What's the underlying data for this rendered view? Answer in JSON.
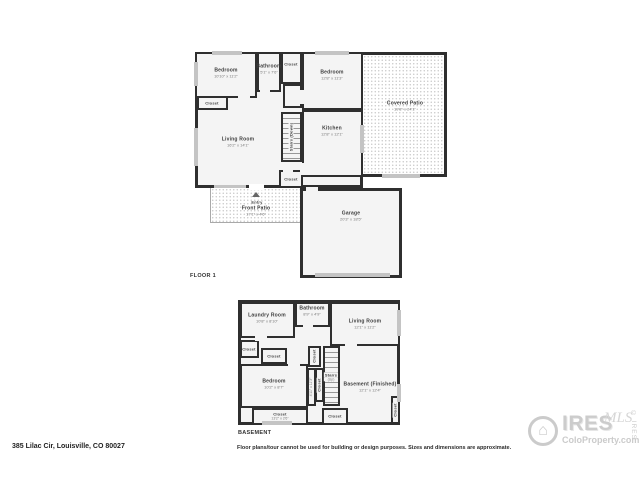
{
  "floor1": {
    "title": "FLOOR 1",
    "rooms": {
      "bedroom1": {
        "name": "Bedroom",
        "dims": "10'10\" x 11'2\""
      },
      "bathroom": {
        "name": "Bathroom",
        "dims": "5'1\" x 7'6\""
      },
      "closet_top": {
        "name": "Closet"
      },
      "bedroom2": {
        "name": "Bedroom",
        "dims": "12'8\" x 11'3\""
      },
      "closet_bed1": {
        "name": "Closet"
      },
      "living_room": {
        "name": "Living Room",
        "dims": "16'2\" x 14'1\""
      },
      "stairs": {
        "name": "Stairs (Down)"
      },
      "kitchen": {
        "name": "Kitchen",
        "dims": "12'8\" x 12'1\""
      },
      "covered_patio": {
        "name": "Covered Patio",
        "dims": "19'8\" x 24'1\""
      },
      "closet_entry": {
        "name": "Closet"
      },
      "entry": {
        "name": "Entry"
      },
      "front_patio": {
        "name": "Front Patio",
        "dims": "17'1\" x 4'6\""
      },
      "garage": {
        "name": "Garage",
        "dims": "20'3\" x 18'5\""
      }
    }
  },
  "basement": {
    "title": "BASEMENT",
    "rooms": {
      "laundry": {
        "name": "Laundry Room",
        "dims": "10'8\" x 8'10\""
      },
      "bathroom": {
        "name": "Bathroom",
        "dims": "8'9\" x 4'9\""
      },
      "living_room": {
        "name": "Living Room",
        "dims": "12'1\" x 11'2\""
      },
      "closet_left": {
        "name": "Closet"
      },
      "closet_left2": {
        "name": "Closet"
      },
      "bedroom": {
        "name": "Bedroom",
        "dims": "10'2\" x 8'7\""
      },
      "closet_stair_top": {
        "name": "Closet"
      },
      "closet_dims": {
        "name": "4'11\" x 11'3\""
      },
      "closet_mid": {
        "name": "Closet"
      },
      "stairs": {
        "name": "Stairs",
        "dims": "(Up)"
      },
      "finished": {
        "name": "Basement (Finished)",
        "dims": "12'1\" x 12'4\""
      },
      "closet_bottom": {
        "name": "Closet",
        "dims": "13'2\" x 2'6\""
      },
      "closet_bottom2": {
        "name": "Closet"
      },
      "closet_right": {
        "name": "Closet"
      }
    }
  },
  "footer": {
    "address": "385 Lilac Cir, Louisville, CO 80027",
    "disclaimer": "Floor plans/tour cannot be used for building or design purposes. Sizes and dimensions are approximate."
  },
  "logo": {
    "house_glyph": "⌂",
    "brand": "IRES",
    "script": "MLS",
    "site": "ColoProperty.com",
    "vertical": "© IRES",
    "color": "#cbcbcb"
  },
  "colors": {
    "wall": "#2f2f2f",
    "room_fill": "#f4f4f4",
    "patio_dot": "#c9c9c9"
  }
}
